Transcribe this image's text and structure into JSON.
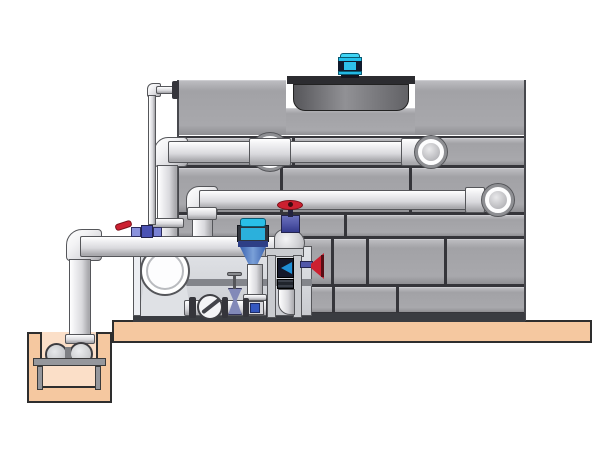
{
  "meta": {
    "title": "Cooling tower and pump skid piping illustration",
    "description": "3D CAD style side view: block-built cooling tower with cyan fan motor, three white pipe runs, pump skid with valves, eductor and instrument stand, sump pit with pump, on a tan concrete slab.",
    "canvas_width": 600,
    "canvas_height": 450
  },
  "palette": {
    "block_face": "#a8a8ac",
    "block_edge": "#cdcdd1",
    "joint": "#35353a",
    "edge_line": "#47484d",
    "cowl_dark": "#56565a",
    "cowl_light": "#919195",
    "cowl_flange": "#2c2c30",
    "motor_cyan": "#24c0ea",
    "motor_dark": "#101a2c",
    "pipe_light": "#f2f2f4",
    "pipe_mid": "#d9d9dd",
    "pipe_dark": "#a9a9ad",
    "pipe_outline": "#55565a",
    "slab": "#f5c8a0",
    "pit_inner": "#fbdfc8",
    "outline_dark": "#2e2e2e",
    "metal_light": "#d6d8dc",
    "metal_mid": "#95979c",
    "base_dark": "#3a3c41",
    "valve_red": "#cc2030",
    "valve_blue": "#5157a8",
    "funnel_blue": "#3f6cb4",
    "panel_dark": "#14182a",
    "arrow_blue": "#1f8fd6"
  },
  "components": {
    "cooling_tower": {
      "label": "Cooling tower block structure"
    },
    "fan_cowl": {
      "label": "Fan discharge cowl"
    },
    "fan_motor": {
      "label": "Cyan fan motor"
    },
    "top_pipe": {
      "label": "Upper distribution pipe run"
    },
    "middle_pipe": {
      "label": "Middle return pipe run"
    },
    "main_header": {
      "label": "Lower pump header pipe"
    },
    "sump_riser": {
      "label": "Riser pipe into sump pit"
    },
    "feed_line": {
      "label": "Small-bore feed line"
    },
    "pump": {
      "label": "Centrifugal pump"
    },
    "skid": {
      "label": "Pump skid backplate"
    },
    "sump_pit": {
      "label": "Sump pit"
    },
    "sump_pump": {
      "label": "Sump pump on stand"
    },
    "slab": {
      "label": "Concrete foundation slab"
    },
    "red_gate_valve": {
      "label": "Gate valve with red handwheel"
    },
    "red_ball_valve": {
      "label": "Ball valve with red lever"
    },
    "butterfly_valve": {
      "label": "Butterfly valve with red wheel"
    },
    "check_valve": {
      "label": "Swing check valve"
    },
    "small_gate_valve": {
      "label": "Small gate valve"
    },
    "sensor_box": {
      "label": "Cyan controller box"
    },
    "eductor": {
      "label": "Blue eductor injection assembly"
    },
    "control_stand": {
      "label": "Instrument stand with panel"
    }
  }
}
